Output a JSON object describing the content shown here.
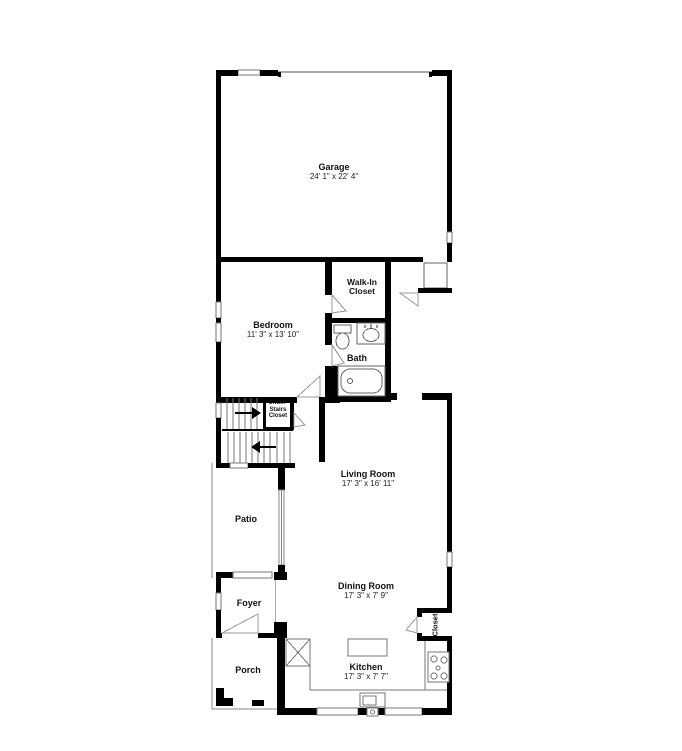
{
  "rooms": {
    "garage": {
      "name": "Garage",
      "dims": "24' 1\" x 22' 4\""
    },
    "bedroom": {
      "name": "Bedroom",
      "dims": "11' 3\" x 13' 10\""
    },
    "walkin": {
      "line1": "Walk-In",
      "line2": "Closet"
    },
    "bath": {
      "name": "Bath"
    },
    "understairs": {
      "line1": "Under-",
      "line2": "Stairs",
      "line3": "Closet"
    },
    "living": {
      "name": "Living Room",
      "dims": "17' 3\" x 16' 11\""
    },
    "patio": {
      "name": "Patio"
    },
    "foyer": {
      "name": "Foyer"
    },
    "porch": {
      "name": "Porch"
    },
    "dining": {
      "name": "Dining Room",
      "dims": "17' 3\" x 7' 9\""
    },
    "kitchen": {
      "name": "Kitchen",
      "dims": "17' 3\" x 7' 7\""
    },
    "closet": {
      "name": "Closet"
    }
  },
  "colors": {
    "wall": "#000000",
    "thin_line": "#888888",
    "background": "#ffffff"
  }
}
